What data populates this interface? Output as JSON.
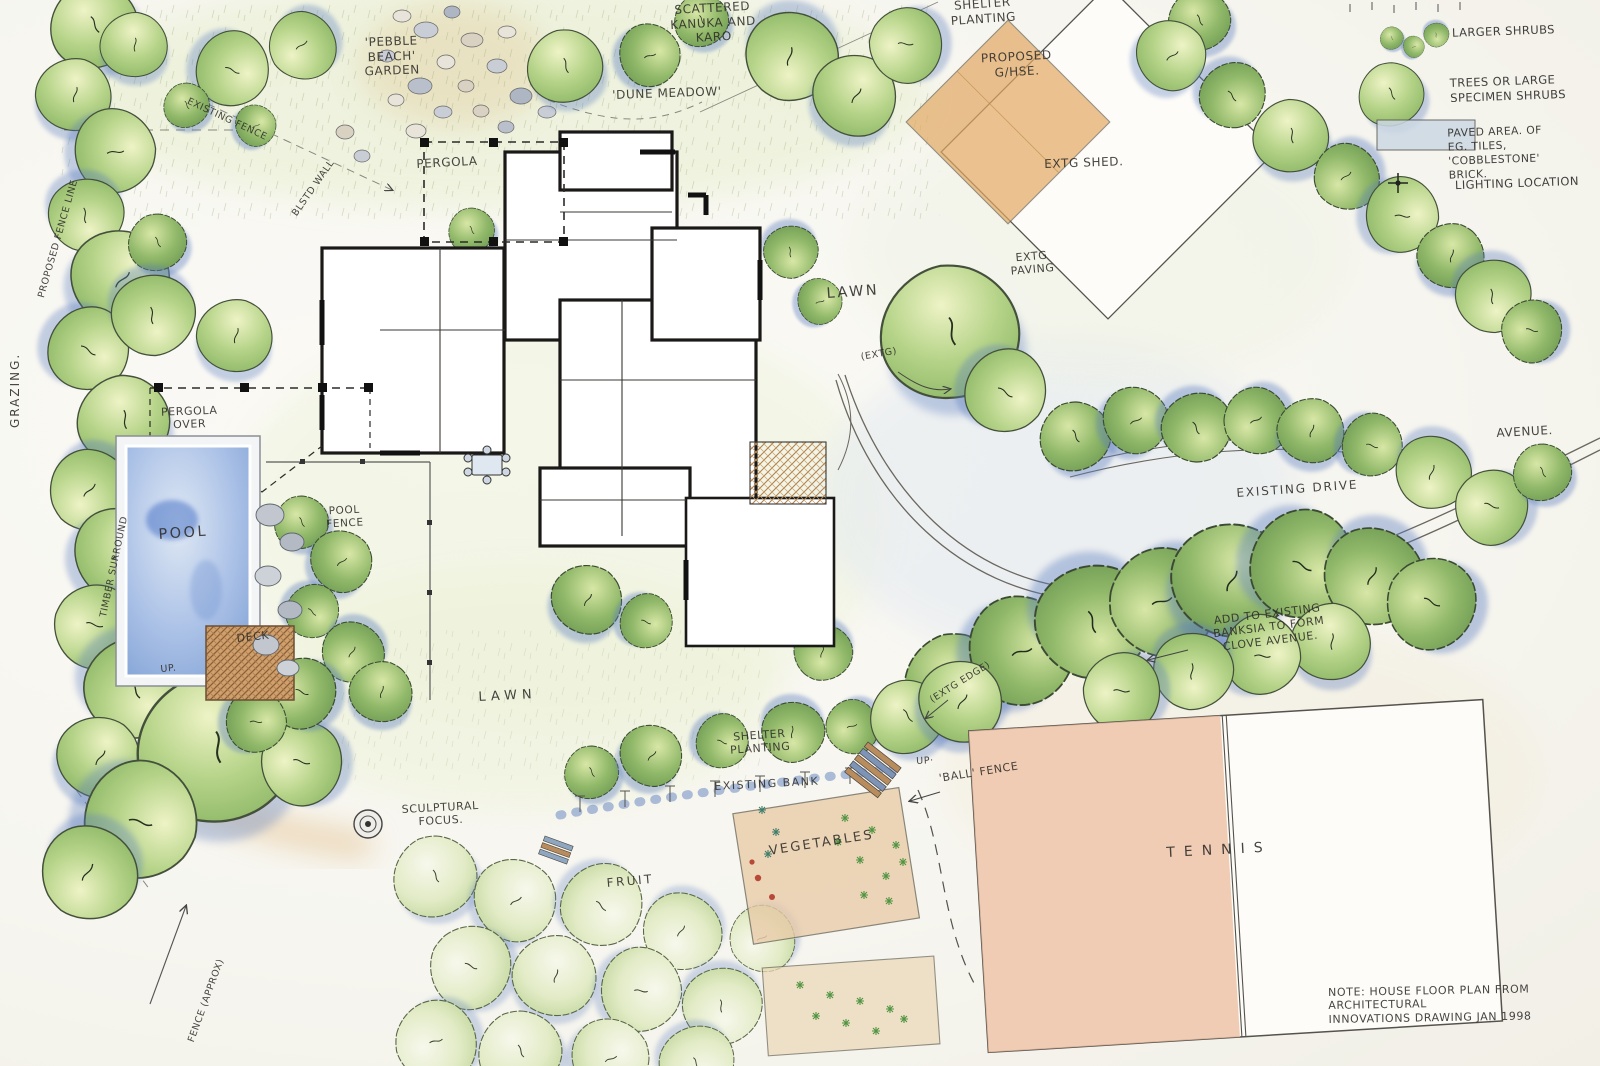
{
  "labels": {
    "scattered_kanuka": "SCATTERED\nKANUKA AND\nKARO",
    "pebble_beach_garden": "'PEBBLE\nBEACH'\nGARDEN",
    "dune_meadow": "'DUNE MEADOW'",
    "shelter_planting_top": "SHELTER\nPLANTING",
    "proposed_ghse": "PROPOSED\nG/HSE.",
    "extg_shed": "EXTG SHED.",
    "extg_paving": "EXTG\nPAVING",
    "pergola": "PERGOLA",
    "lawn_upper": "LAWN",
    "extg_marker": "(EXTG)",
    "grazing": "GRAZING.",
    "proposed_fence_line": "PROPOSED FENCE LINE",
    "existing_fence": "EXISTING FENCE",
    "wall": "BLSTD WALL",
    "pergola_over": "PERGOLA\nOVER",
    "pool": "POOL",
    "timber_surround": "TIMBER SURROUND",
    "pool_fence": "POOL\nFENCE",
    "deck": "DECK",
    "up_pool": "UP.",
    "avenue": "AVENUE.",
    "existing_drive": "EXISTING DRIVE",
    "banksia_note": "ADD TO EXISTING\nBANKSIA TO FORM\nCLOVE AVENUE.",
    "extg_edge": "(EXTG EDGE)",
    "shelter_planting_bottom": "SHELTER\nPLANTING",
    "existing_bank": "EXISTING BANK",
    "up_steps": "UP·",
    "ball_fence": "'BALL' FENCE",
    "sculptural_focus": "SCULPTURAL\nFOCUS.",
    "vegetables": "VEGETABLES",
    "tennis": "TENNIS",
    "fruit": "FRUIT",
    "lawn_lower": "LAWN",
    "fence_approx": "FENCE (APPROX)"
  },
  "legend": {
    "larger_shrubs": "LARGER SHRUBS",
    "trees_specimen": "TREES OR LARGE\nSPECIMEN SHRUBS",
    "paved_area": "PAVED AREA. OF\nEG. TILES, 'COBBLESTONE'\nBRICK.",
    "lighting_location": "LIGHTING LOCATION"
  },
  "note": "NOTE: HOUSE FLOOR PLAN FROM ARCHITECTURAL\nINNOVATIONS DRAWING JAN 1998",
  "colors": {
    "foliage_green": "#9cc27a",
    "shadow_blue": "#5d7fc0",
    "pool_blue": "#7fa3d8",
    "tennis_clay": "#ecbfa2",
    "deck_timber": "#c79a6b",
    "glasshouse_tan": "#e2a963",
    "ink": "#2e2c28",
    "paper": "#f7f6f1"
  }
}
